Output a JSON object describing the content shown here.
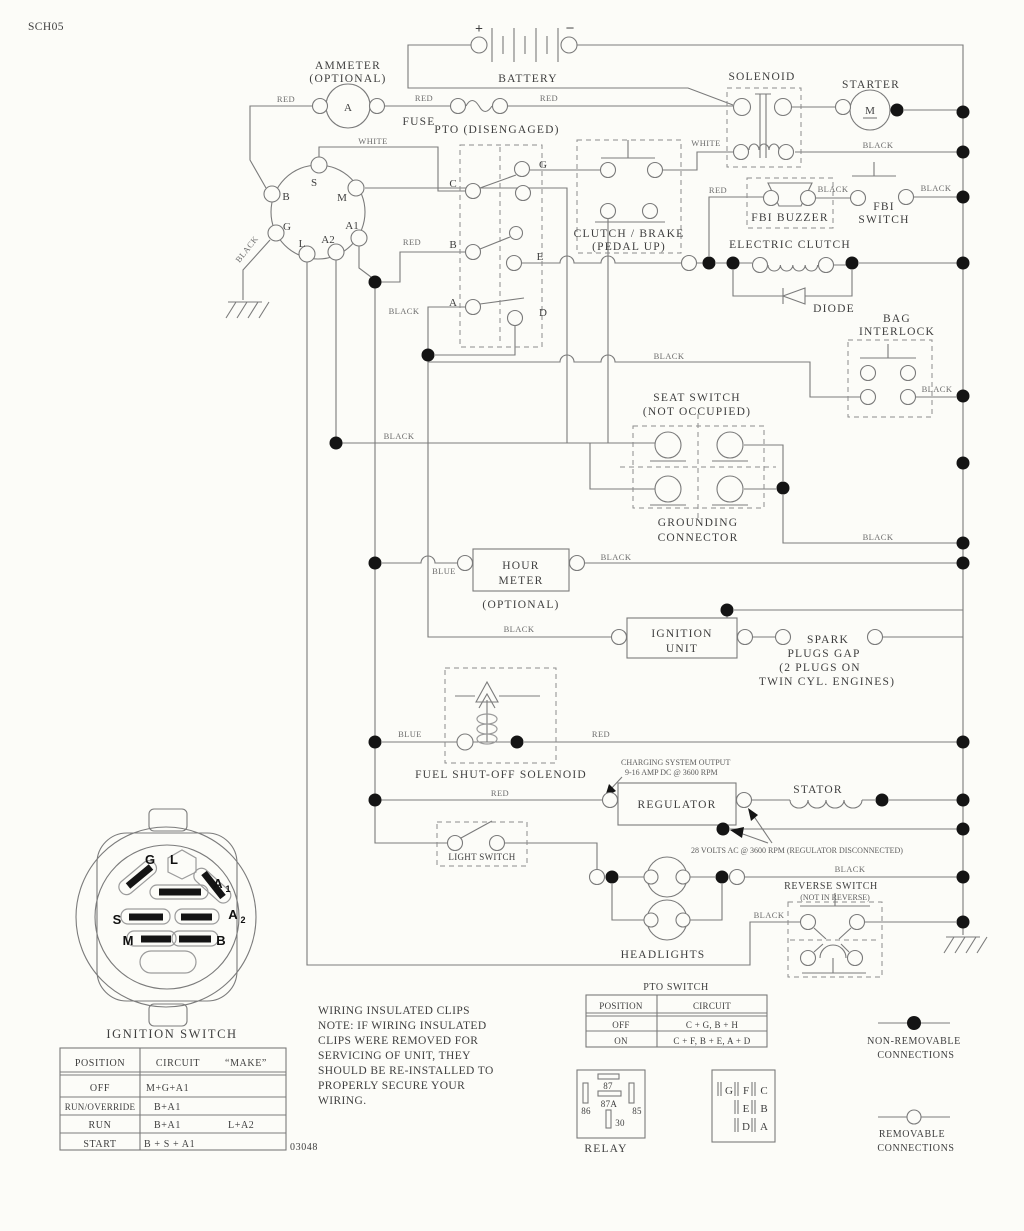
{
  "page": {
    "code": "SCH05",
    "drawing_number": "03048"
  },
  "wire": {
    "red": "RED",
    "black": "BLACK",
    "white": "WHITE",
    "blue": "BLUE"
  },
  "parts": {
    "ammeter1": "AMMETER",
    "ammeter2": "(OPTIONAL)",
    "ammeter_a": "A",
    "plus": "+",
    "minus": "–",
    "battery": "BATTERY",
    "fuse": "FUSE",
    "pto": "PTO (DISENGAGED)",
    "solenoid": "SOLENOID",
    "starter": "STARTER",
    "starter_m": "M",
    "buzzer": "FBI BUZZER",
    "fbi1": "FBI",
    "fbi2": "SWITCH",
    "clutch1": "CLUTCH / BRAKE",
    "clutch2": "(PEDAL UP)",
    "eclutch": "ELECTRIC CLUTCH",
    "diode": "DIODE",
    "bag1": "BAG",
    "bag2": "INTERLOCK",
    "seat1": "SEAT SWITCH",
    "seat2": "(NOT OCCUPIED)",
    "gnd1": "GROUNDING",
    "gnd2": "CONNECTOR",
    "hour1": "HOUR",
    "hour2": "METER",
    "hour3": "(OPTIONAL)",
    "ign1": "IGNITION",
    "ign2": "UNIT",
    "spark1": "SPARK",
    "spark2": "PLUGS GAP",
    "spark3": "(2 PLUGS ON",
    "spark4": "TWIN CYL. ENGINES)",
    "fuel": "FUEL SHUT-OFF SOLENOID",
    "chg1": "CHARGING SYSTEM OUTPUT",
    "chg2": "9-16 AMP DC @ 3600 RPM",
    "regulator": "REGULATOR",
    "stator": "STATOR",
    "volts": "28 VOLTS AC @ 3600 RPM (REGULATOR DISCONNECTED)",
    "light": "LIGHT SWITCH",
    "headlights": "HEADLIGHTS",
    "rev1": "REVERSE SWITCH",
    "rev2": "(NOT IN REVERSE)"
  },
  "ignition_plug": {
    "s": "S",
    "m": "M",
    "b": "B",
    "g": "G",
    "l": "L",
    "a1": "A1",
    "a2": "A2"
  },
  "pto_pins": {
    "c": "C",
    "g": "G",
    "b": "B",
    "e": "E",
    "a": "A",
    "d": "D"
  },
  "key_drawing": {
    "title": "IGNITION SWITCH",
    "g": "G",
    "l": "L",
    "a": "A",
    "sub1": "1",
    "sub2": "2",
    "s": "S",
    "m": "M",
    "b": "B"
  },
  "ignition_table": {
    "h_position": "POSITION",
    "h_circuit": "CIRCUIT",
    "h_make": "“MAKE”",
    "rows": [
      {
        "position": "OFF",
        "circuit": "M+G+A1",
        "make": ""
      },
      {
        "position": "RUN/OVERRIDE",
        "circuit": "B+A1",
        "make": ""
      },
      {
        "position": "RUN",
        "circuit": "B+A1",
        "make": "L+A2"
      },
      {
        "position": "START",
        "circuit": "B + S + A1",
        "make": ""
      }
    ]
  },
  "note": [
    "WIRING INSULATED CLIPS",
    "NOTE:  IF WIRING INSULATED",
    "CLIPS WERE REMOVED FOR",
    "SERVICING OF UNIT, THEY",
    "SHOULD BE RE-INSTALLED TO",
    "PROPERLY SECURE YOUR",
    "WIRING."
  ],
  "pto_table": {
    "title": "PTO SWITCH",
    "h_position": "POSITION",
    "h_circuit": "CIRCUIT",
    "rows": [
      {
        "position": "OFF",
        "circuit": "C + G, B + H"
      },
      {
        "position": "ON",
        "circuit": "C + F, B + E, A + D"
      }
    ]
  },
  "relay": {
    "label": "RELAY",
    "p87": "87",
    "p87a": "87A",
    "p86": "86",
    "p85": "85",
    "p30": "30"
  },
  "plug_legend": {
    "g": "G",
    "f": "F",
    "c": "C",
    "e": "E",
    "b": "B",
    "d": "D",
    "a": "A"
  },
  "legend": {
    "nr1": "NON-REMOVABLE",
    "nr2": "CONNECTIONS",
    "r1": "REMOVABLE",
    "r2": "CONNECTIONS"
  }
}
